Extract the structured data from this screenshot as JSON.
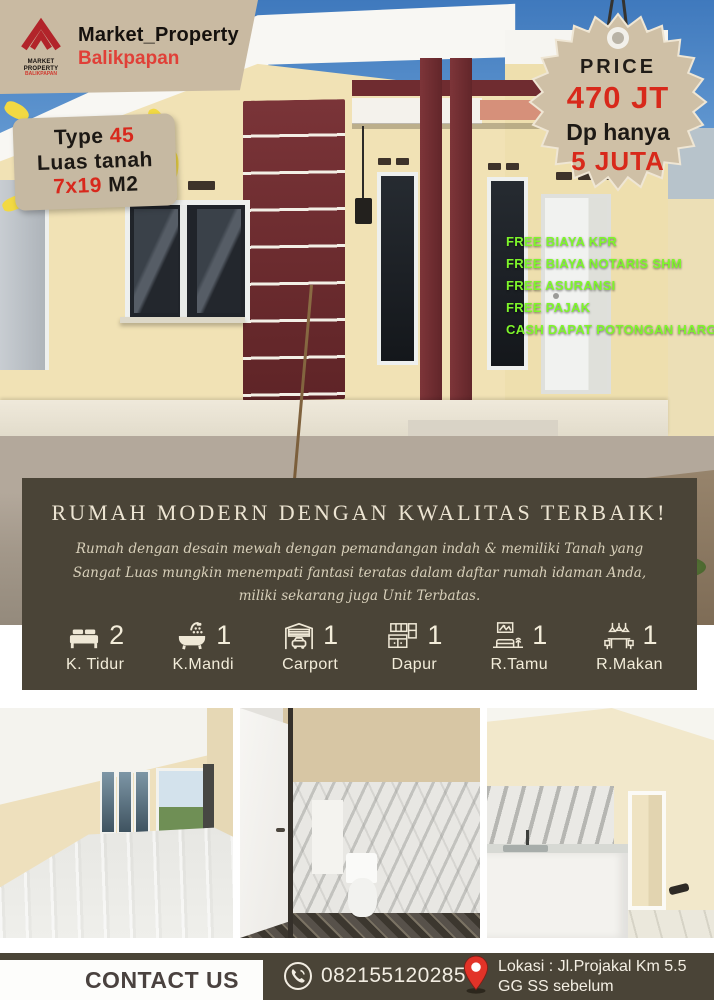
{
  "brand": {
    "title": "Market_Property",
    "subtitle": "Balikpapan",
    "mark_caption": "MARKET PROPERTY",
    "mark_sub": "BALIKPAPAN"
  },
  "type_badge": {
    "line1_black": "Type ",
    "line1_red": "45",
    "line2": "Luas tanah",
    "line3_red": "7x19",
    "line3_black": " M2"
  },
  "price_badge": {
    "label": "PRICE",
    "value": "470 JT",
    "dp_label": "Dp hanya",
    "dp_value": "5 JUTA"
  },
  "free_list": {
    "items": [
      "FREE BIAYA KPR",
      "FREE BIAYA NOTARIS SHM",
      "FREE ASURANSI",
      "FREE PAJAK",
      "CASH DAPAT POTONGAN HARGA & BONUS MENARIK"
    ]
  },
  "overlay": {
    "headline": "RUMAH MODERN DENGAN KWALITAS TERBAIK!",
    "description": "Rumah dengan desain mewah dengan pemandangan indah & memiliki Tanah yang Sangat Luas mungkin menempati fantasi teratas dalam daftar rumah idaman Anda, miliki sekarang juga Unit Terbatas."
  },
  "features": {
    "items": [
      {
        "icon": "bed-icon",
        "count": "2",
        "label": "K. Tidur"
      },
      {
        "icon": "bath-icon",
        "count": "1",
        "label": "K.Mandi"
      },
      {
        "icon": "carport-icon",
        "count": "1",
        "label": "Carport"
      },
      {
        "icon": "kitchen-icon",
        "count": "1",
        "label": "Dapur"
      },
      {
        "icon": "living-room-icon",
        "count": "1",
        "label": "R.Tamu"
      },
      {
        "icon": "dining-room-icon",
        "count": "1",
        "label": "R.Makan"
      }
    ]
  },
  "contact": {
    "heading": "CONTACT US",
    "phone": "082155120285",
    "location_line1": "Lokasi : Jl.Projakal Km 5.5",
    "location_line2": "GG SS sebelum"
  },
  "colors": {
    "olive": "#4a4437",
    "maroon": "#6f2c30",
    "cream_wall": "#f1e2b5",
    "badge_tan": "#c9baa2",
    "free_green": "#7ef52b",
    "price_red": "#d8291b",
    "brand_red": "#e04038",
    "splash_yellow": "#f2d943"
  }
}
